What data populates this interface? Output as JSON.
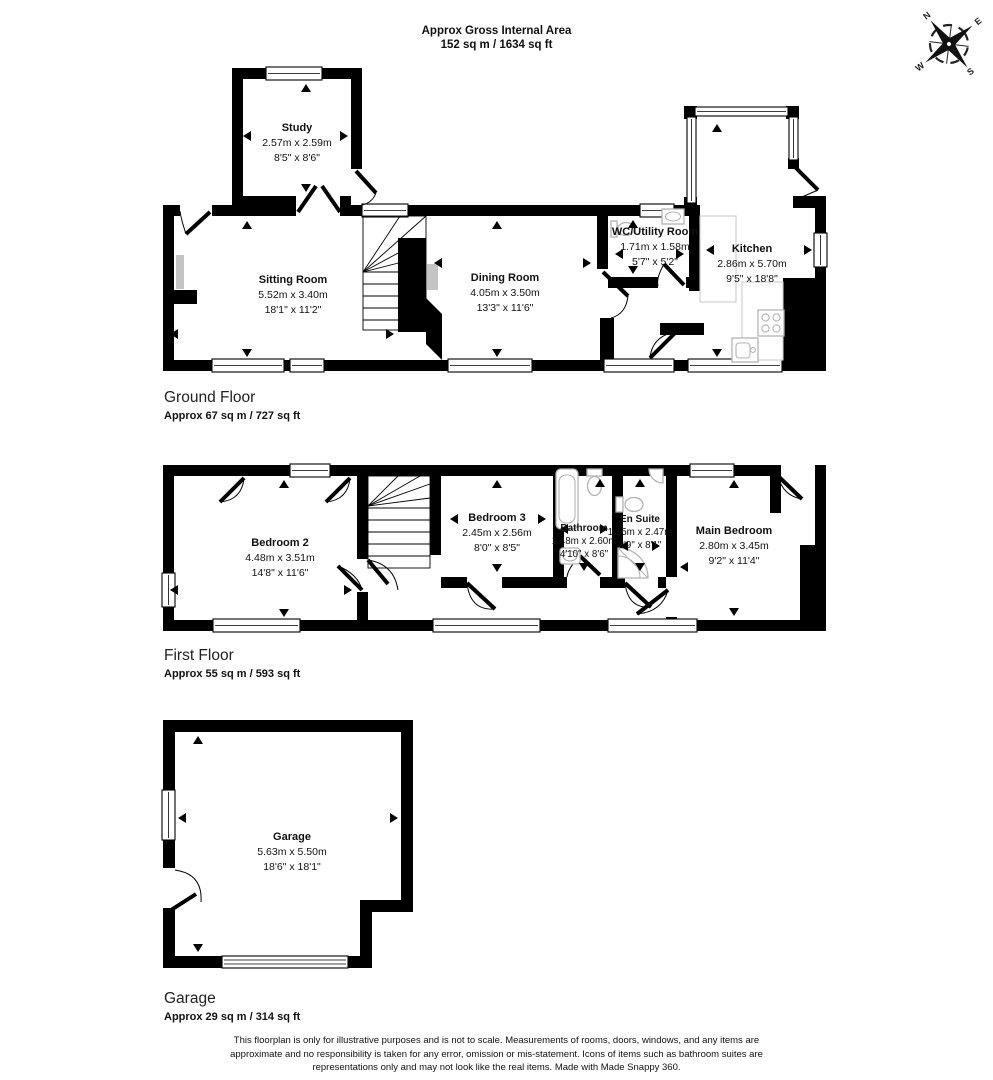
{
  "header": {
    "title": "Approx Gross Internal Area",
    "area": "152 sq m / 1634 sq ft"
  },
  "compass": {
    "n": "N",
    "e": "E",
    "s": "S",
    "w": "W"
  },
  "floors": [
    {
      "name": "Ground Floor",
      "area": "Approx 67 sq m / 727 sq ft",
      "rooms": [
        {
          "name": "Study",
          "metric": "2.57m x 2.59m",
          "imperial": "8'5\" x 8'6\""
        },
        {
          "name": "Sitting Room",
          "metric": "5.52m x 3.40m",
          "imperial": "18'1\" x 11'2\""
        },
        {
          "name": "Dining Room",
          "metric": "4.05m x 3.50m",
          "imperial": "13'3\" x 11'6\""
        },
        {
          "name": "WC/Utility Room",
          "metric": "1.71m x 1.58m",
          "imperial": "5'7\" x 5'2\""
        },
        {
          "name": "Kitchen",
          "metric": "2.86m x 5.70m",
          "imperial": "9'5\" x 18'8\""
        }
      ]
    },
    {
      "name": "First Floor",
      "area": "Approx 55 sq m / 593 sq ft",
      "rooms": [
        {
          "name": "Bedroom 2",
          "metric": "4.48m x 3.51m",
          "imperial": "14'8\" x 11'6\""
        },
        {
          "name": "Bedroom 3",
          "metric": "2.45m x 2.56m",
          "imperial": "8'0\" x 8'5\""
        },
        {
          "name": "Bathroom",
          "metric": "1.48m x 2.60m",
          "imperial": "4'10\" x 8'6\""
        },
        {
          "name": "En Suite",
          "metric": "1.15m x 2.47m",
          "imperial": "3'9\" x 8'1\""
        },
        {
          "name": "Main Bedroom",
          "metric": "2.80m x 3.45m",
          "imperial": "9'2\" x 11'4\""
        }
      ]
    },
    {
      "name": "Garage",
      "area": "Approx 29 sq m / 314 sq ft",
      "rooms": [
        {
          "name": "Garage",
          "metric": "5.63m x 5.50m",
          "imperial": "18'6\" x 18'1\""
        }
      ]
    }
  ],
  "footer": {
    "disclaimer": "This floorplan is only for illustrative purposes and is not to scale. Measurements of rooms, doors, windows, and any items are approximate and no responsibility is taken for any error, omission or mis-statement. Icons of items such as bathroom suites are representations only and may not look like the real items. Made with Made Snappy 360."
  }
}
